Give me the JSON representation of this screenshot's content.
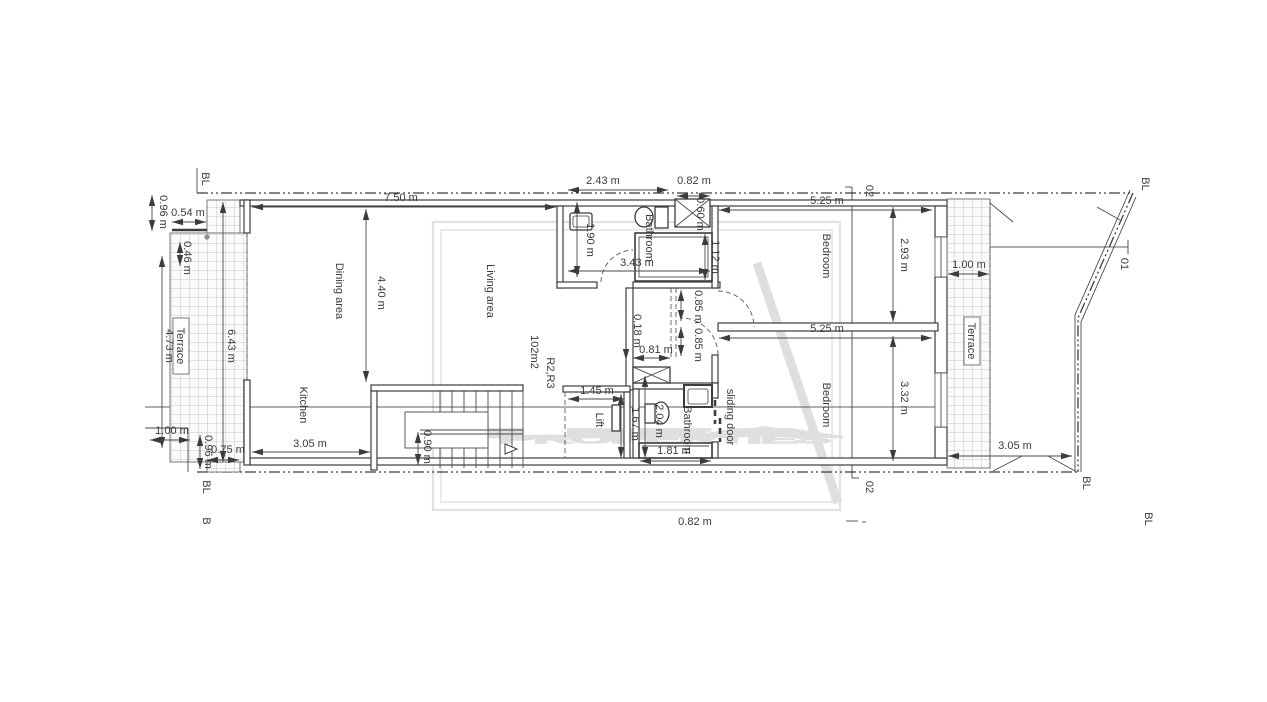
{
  "watermark": {
    "brand": "LEA",
    "brand_sub": "PROPERTIES"
  },
  "rooms": {
    "dining": "Dining area",
    "living": "Living area",
    "kitchen": "Kitchen",
    "bathroom": "Bathroom",
    "bedroom": "Bedroom",
    "lift": "Lift",
    "terrace": "Terrace",
    "sliding_door": "sliding door",
    "area_label": "102m2",
    "unit_label": "R2,R3"
  },
  "dims": {
    "d750": "7.50 m",
    "d440": "4.40 m",
    "d243": "2.43 m",
    "d082": "0.82 m",
    "d054": "0.54 m",
    "d046": "0.46 m",
    "d096": "0.96 m",
    "d473": "4.73 m",
    "d643": "6.43 m",
    "d190": "1.90 m",
    "d343": "3.43 m",
    "d112": "1.12 m",
    "d060": "0.60 m",
    "d100": "1.00 m",
    "d075": "0.75 m",
    "d305": "3.05 m",
    "d090": "0.90 m",
    "d145": "1.45 m",
    "d167": "1.67 m",
    "d204": "2.04 m",
    "d181": "1.81 m",
    "d018": "0.18 m",
    "d081": "0.81 m",
    "d085": "0.85 m",
    "d525": "5.25 m",
    "d293": "2.93 m",
    "d332": "3.32 m"
  },
  "markers": {
    "bl": "BL",
    "b": "B",
    "s01": "01",
    "s02": "02"
  }
}
